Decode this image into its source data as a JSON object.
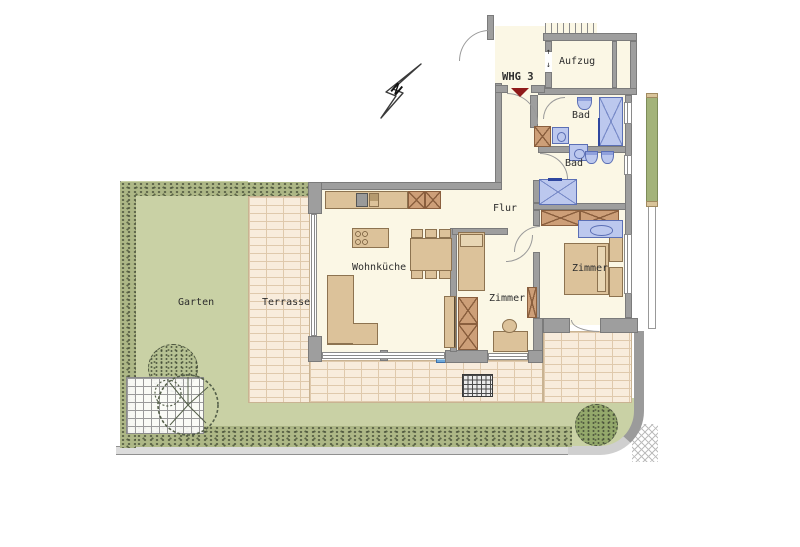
{
  "plan": {
    "labels": {
      "whg": "WHG 3",
      "aufzug": "Aufzug",
      "bad_top": "Bad",
      "bad_mid": "Bad",
      "flur": "Flur",
      "wohnkueche": "Wohnküche",
      "zimmer_small": "Zimmer",
      "zimmer_right": "Zimmer",
      "terrasse": "Terrasse",
      "garten": "Garten"
    },
    "compass": {
      "north": "N"
    },
    "elevator": {
      "arrow_up": "↑",
      "arrow_down": "↓"
    },
    "colors": {
      "wall": "#9E9E9E",
      "floor": "#FBF7E5",
      "furniture": "#DCC29A",
      "cabinet": "#CD9F78",
      "fixture_blue": "#BCC8EE",
      "terrace_paving": "#F8ECDC",
      "garden_green": "#C9D1A5",
      "entrance_marker": "#8F1A1A"
    }
  }
}
